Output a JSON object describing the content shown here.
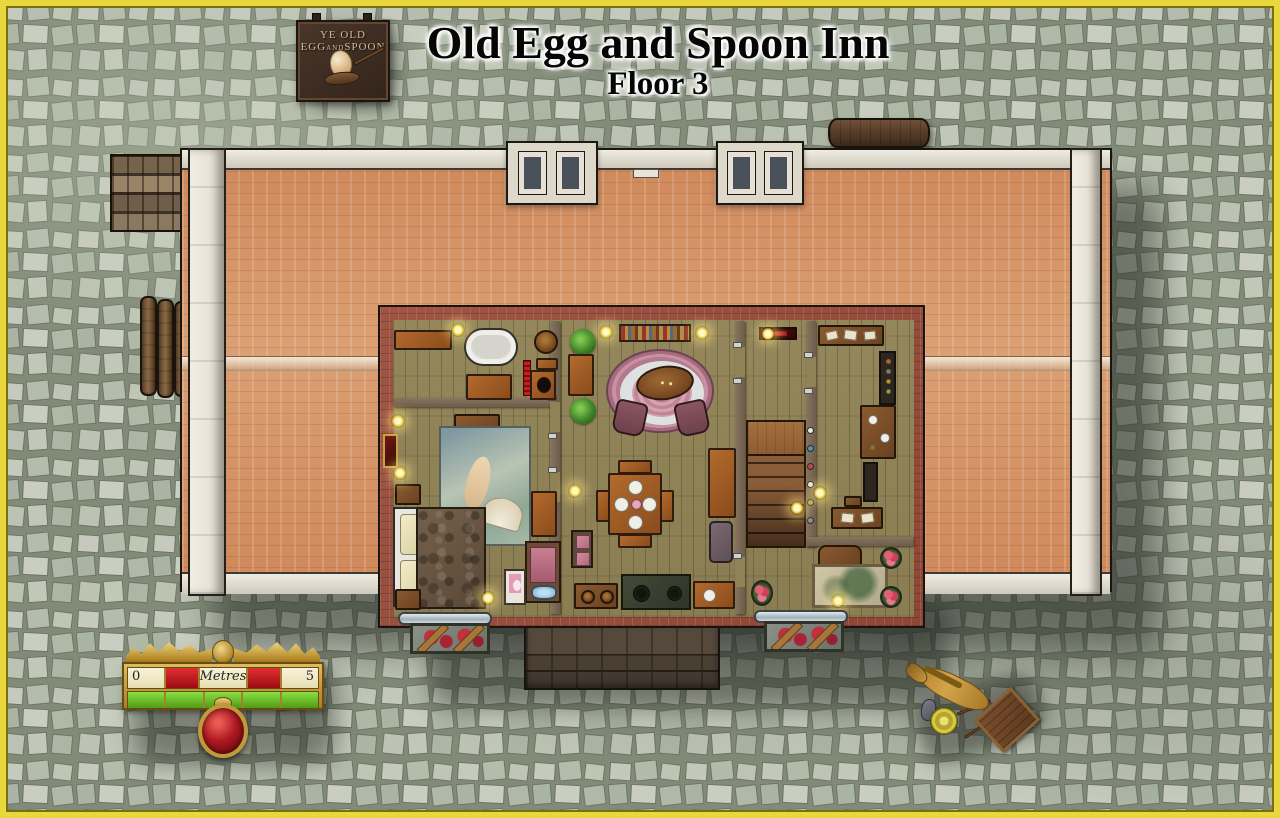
{
  "title": {
    "main": "Old Egg and Spoon Inn",
    "subtitle": "Floor 3"
  },
  "sign": {
    "line1": "YE OLD",
    "word_egg": "EGG",
    "word_and": "AND",
    "word_spoon": "SPOON"
  },
  "scale_bar": {
    "start": "0",
    "unit": "Metres",
    "end": "5",
    "segment_count": 5
  },
  "palette": {
    "border_yellow": "#e8d83c",
    "roof": "#cf885a",
    "trim": "#e8e3d8",
    "brick": "#8e4636",
    "floor": "#8a7d52",
    "stair": "#8a5c38",
    "fur": "#75604a",
    "scale_gold": "#a87f24",
    "scale_red": "#9c0c14",
    "scale_green": "#4f9c16",
    "scale_cream": "#e6deb2",
    "medallion": "#b01822",
    "horse": "#d2a44a",
    "cart": "#5e3a20",
    "shadow": "rgba(33,36,30,0.45)"
  }
}
